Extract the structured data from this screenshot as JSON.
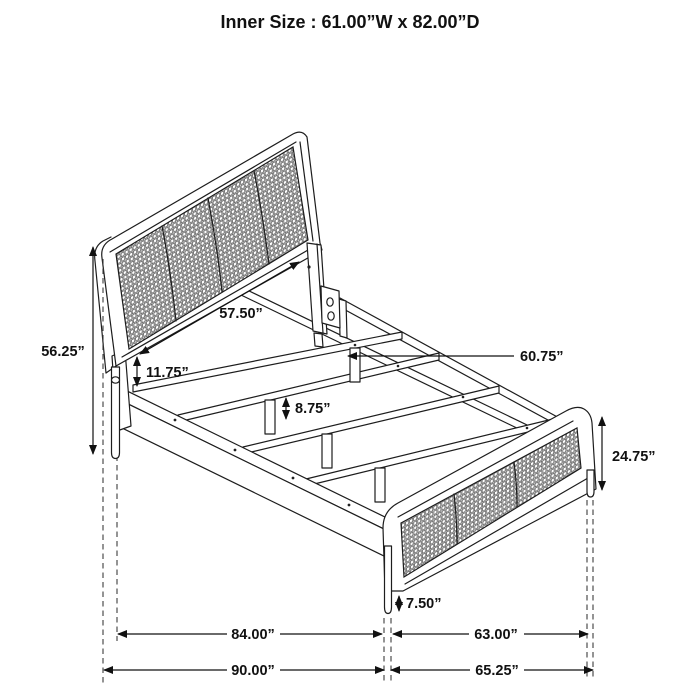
{
  "title": "Inner Size : 61.00”W x 82.00”D",
  "diagram": {
    "subject": "isometric line drawing of a cane-panel bed frame with dimension callouts",
    "line_color": "#1d1d1d",
    "mesh_color": "#4d4d4d",
    "background": "#ffffff"
  },
  "dimensions": {
    "headboard_height": "56.25”",
    "headboard_panel_width": "57.50”",
    "panel_bottom_to_rail": "11.75”",
    "slat_leg_height": "8.75”",
    "slat_length": "60.75”",
    "footboard_height": "24.75”",
    "footboard_leg_height": "7.50”",
    "inner_length": "84.00”",
    "inner_width": "63.00”",
    "overall_length": "90.00”",
    "overall_width": "65.25”"
  }
}
